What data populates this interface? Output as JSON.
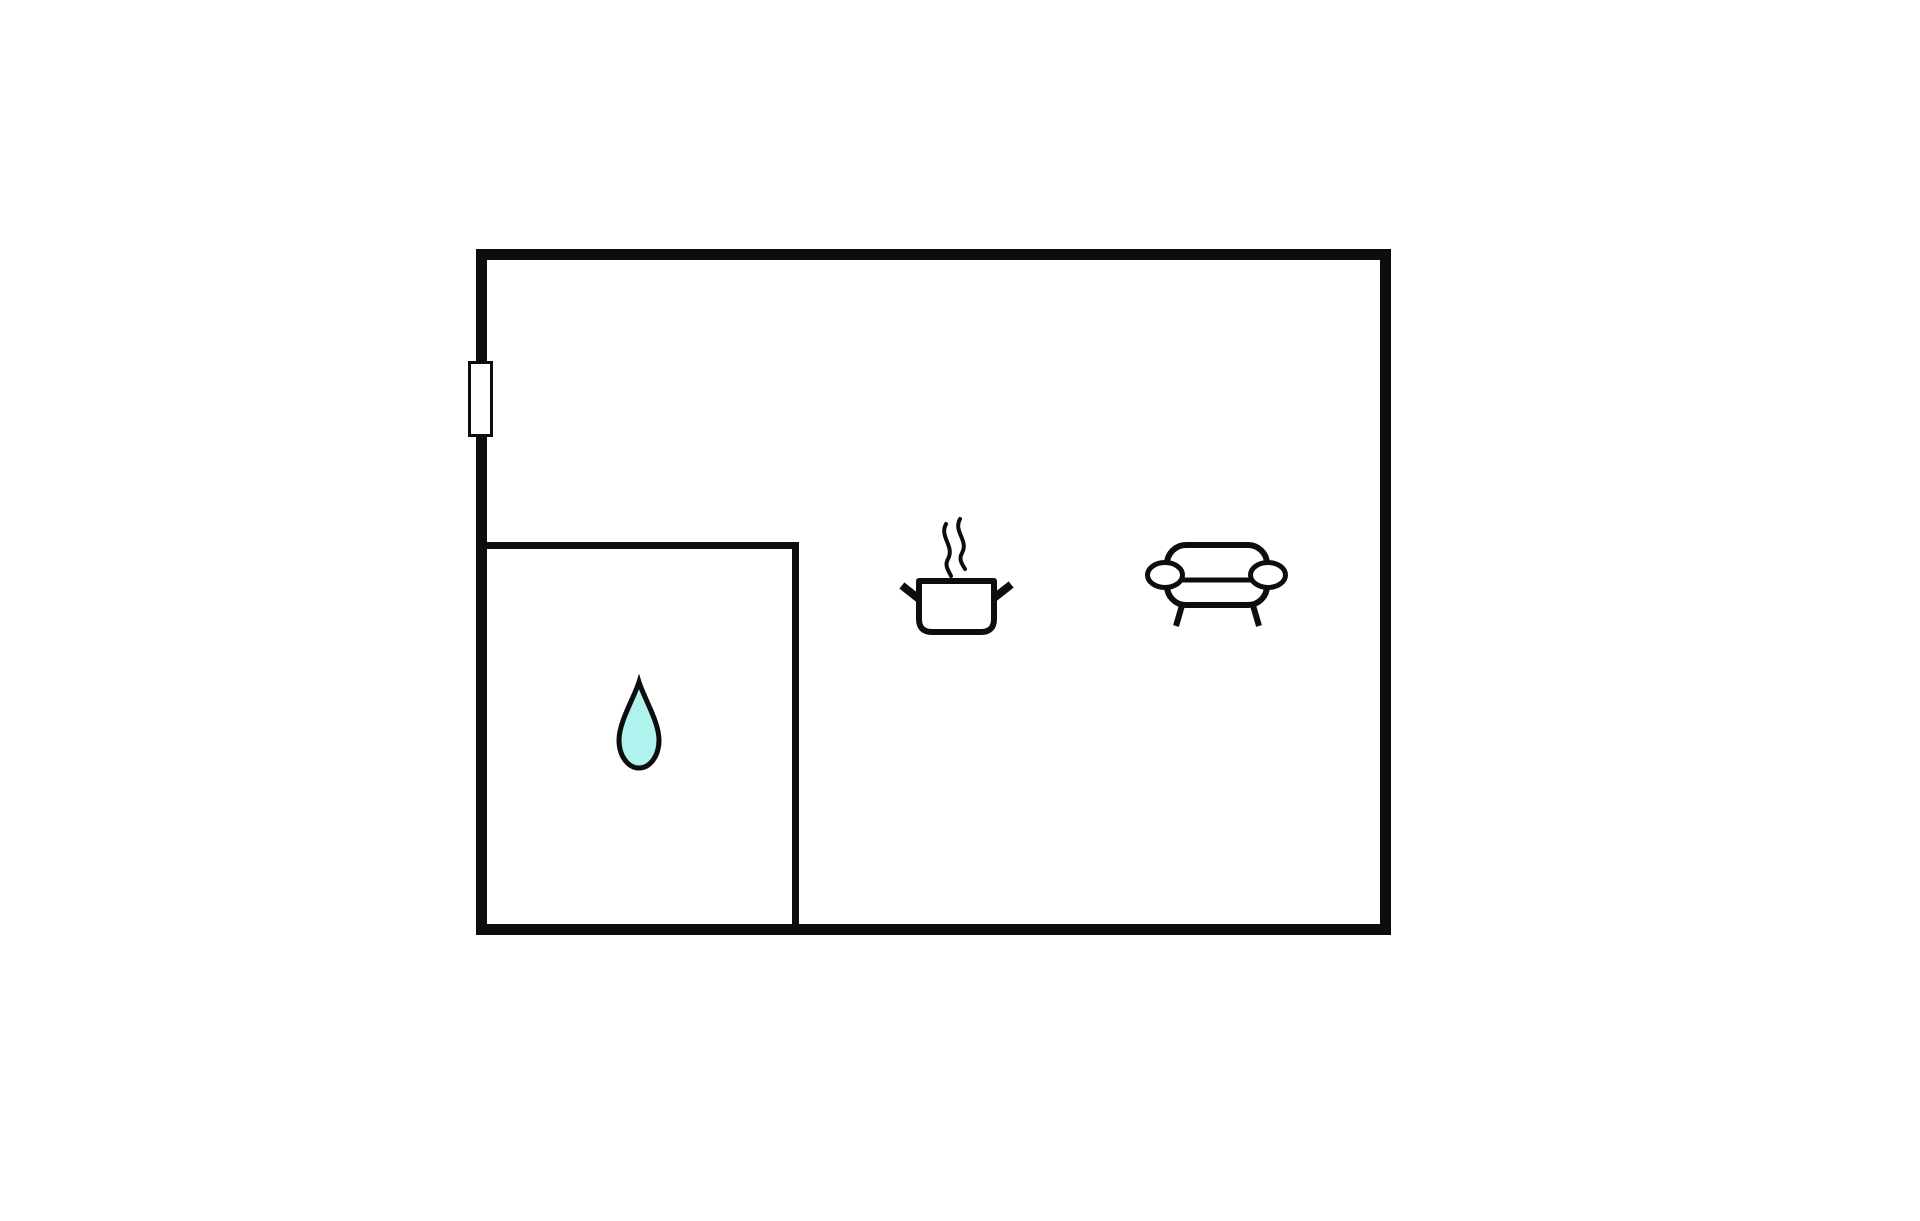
{
  "page": {
    "kind": "floor-plan-diagram",
    "background": "#ffffff"
  },
  "floor_plan": {
    "rooms": [
      {
        "name": "main-room",
        "position": "full",
        "features": [
          "window-marker",
          "pot-steam-icon",
          "sofa-icon"
        ]
      },
      {
        "name": "bathroom",
        "position": "bottom-left",
        "features": [
          "water-drop-icon"
        ]
      }
    ],
    "icons": [
      {
        "name": "window-marker"
      },
      {
        "name": "water-drop-icon"
      },
      {
        "name": "pot-steam-icon"
      },
      {
        "name": "sofa-icon"
      }
    ],
    "colors": {
      "wall": "#0d0d0d",
      "background": "#ffffff",
      "water_drop_fill": "#aff2ee",
      "icon_fill": "#ffffff"
    }
  }
}
